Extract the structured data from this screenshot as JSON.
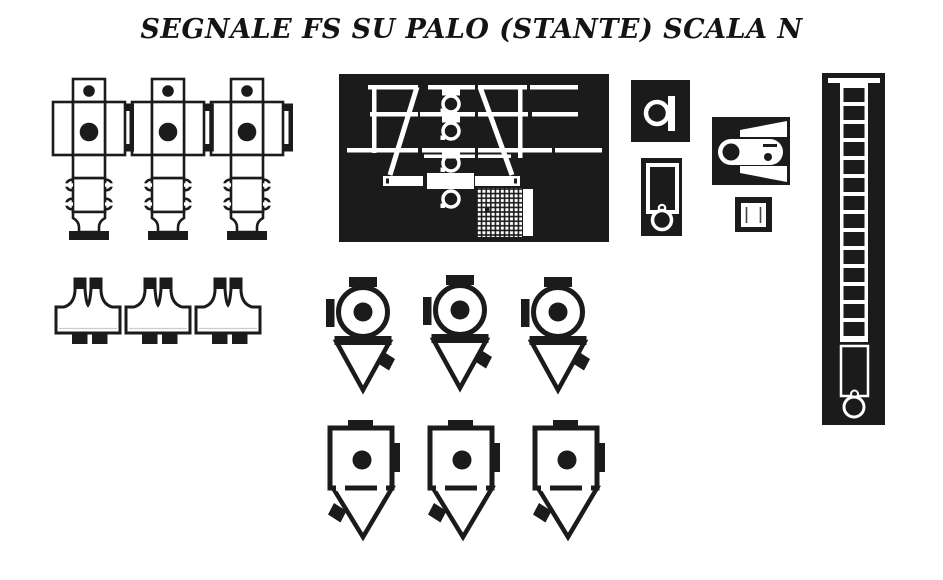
{
  "header": {
    "title": "SEGNALE FS SU PALO (STANTE) SCALA N"
  },
  "colors": {
    "ink": "#1b1b1b",
    "paper": "#ffffff"
  }
}
